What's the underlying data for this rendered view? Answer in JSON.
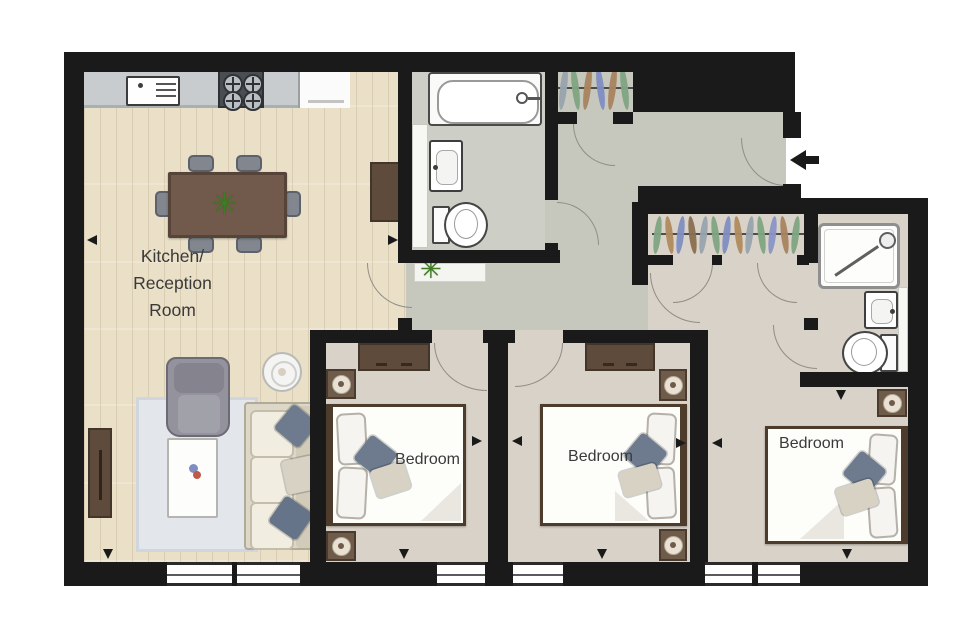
{
  "meta": {
    "kind": "apartment-floorplan",
    "rooms_shown": 6
  },
  "labels": {
    "room_kitchen": [
      "Kitchen/",
      "Reception",
      "Room"
    ],
    "bedroom_a": "Bedroom",
    "bedroom_b": "Bedroom",
    "bedroom_c": "Bedroom"
  },
  "colors": {
    "wall": "#1a1a1a",
    "wood": "#eadfc7",
    "hall": "#c7c8bd",
    "bath": "#cdcec6",
    "bedfloor": "#d9d2c8",
    "counter": "#c8ccce",
    "arcline": "#8e8e86",
    "text": "#3a3a3a",
    "tablebrown": "#71594b",
    "darkfurn": "#5e4b3c",
    "chair": "#81868f",
    "sofa": "#ddd7c7",
    "rug": "#e3e7ec",
    "pillowgray": "#6e7b8e",
    "pillowbeige": "#d8d2c5",
    "plant": "#3f7d24"
  },
  "closets": {
    "closet1": {
      "hangers": [
        "#99a3ad",
        "#7fa482",
        "#a8845f",
        "#7f8ec2",
        "#a8845f",
        "#7fa482"
      ]
    },
    "closet2": {
      "hangers": [
        "#7fa482",
        "#b08a5e",
        "#7f8ec2",
        "#8a6f4f",
        "#99a3ad",
        "#7fa482",
        "#7f8ec2",
        "#b08a5e",
        "#99a3ad",
        "#7fa482",
        "#8a93c6",
        "#a8845f",
        "#7fa482"
      ]
    }
  },
  "plant_glyph": "✳"
}
